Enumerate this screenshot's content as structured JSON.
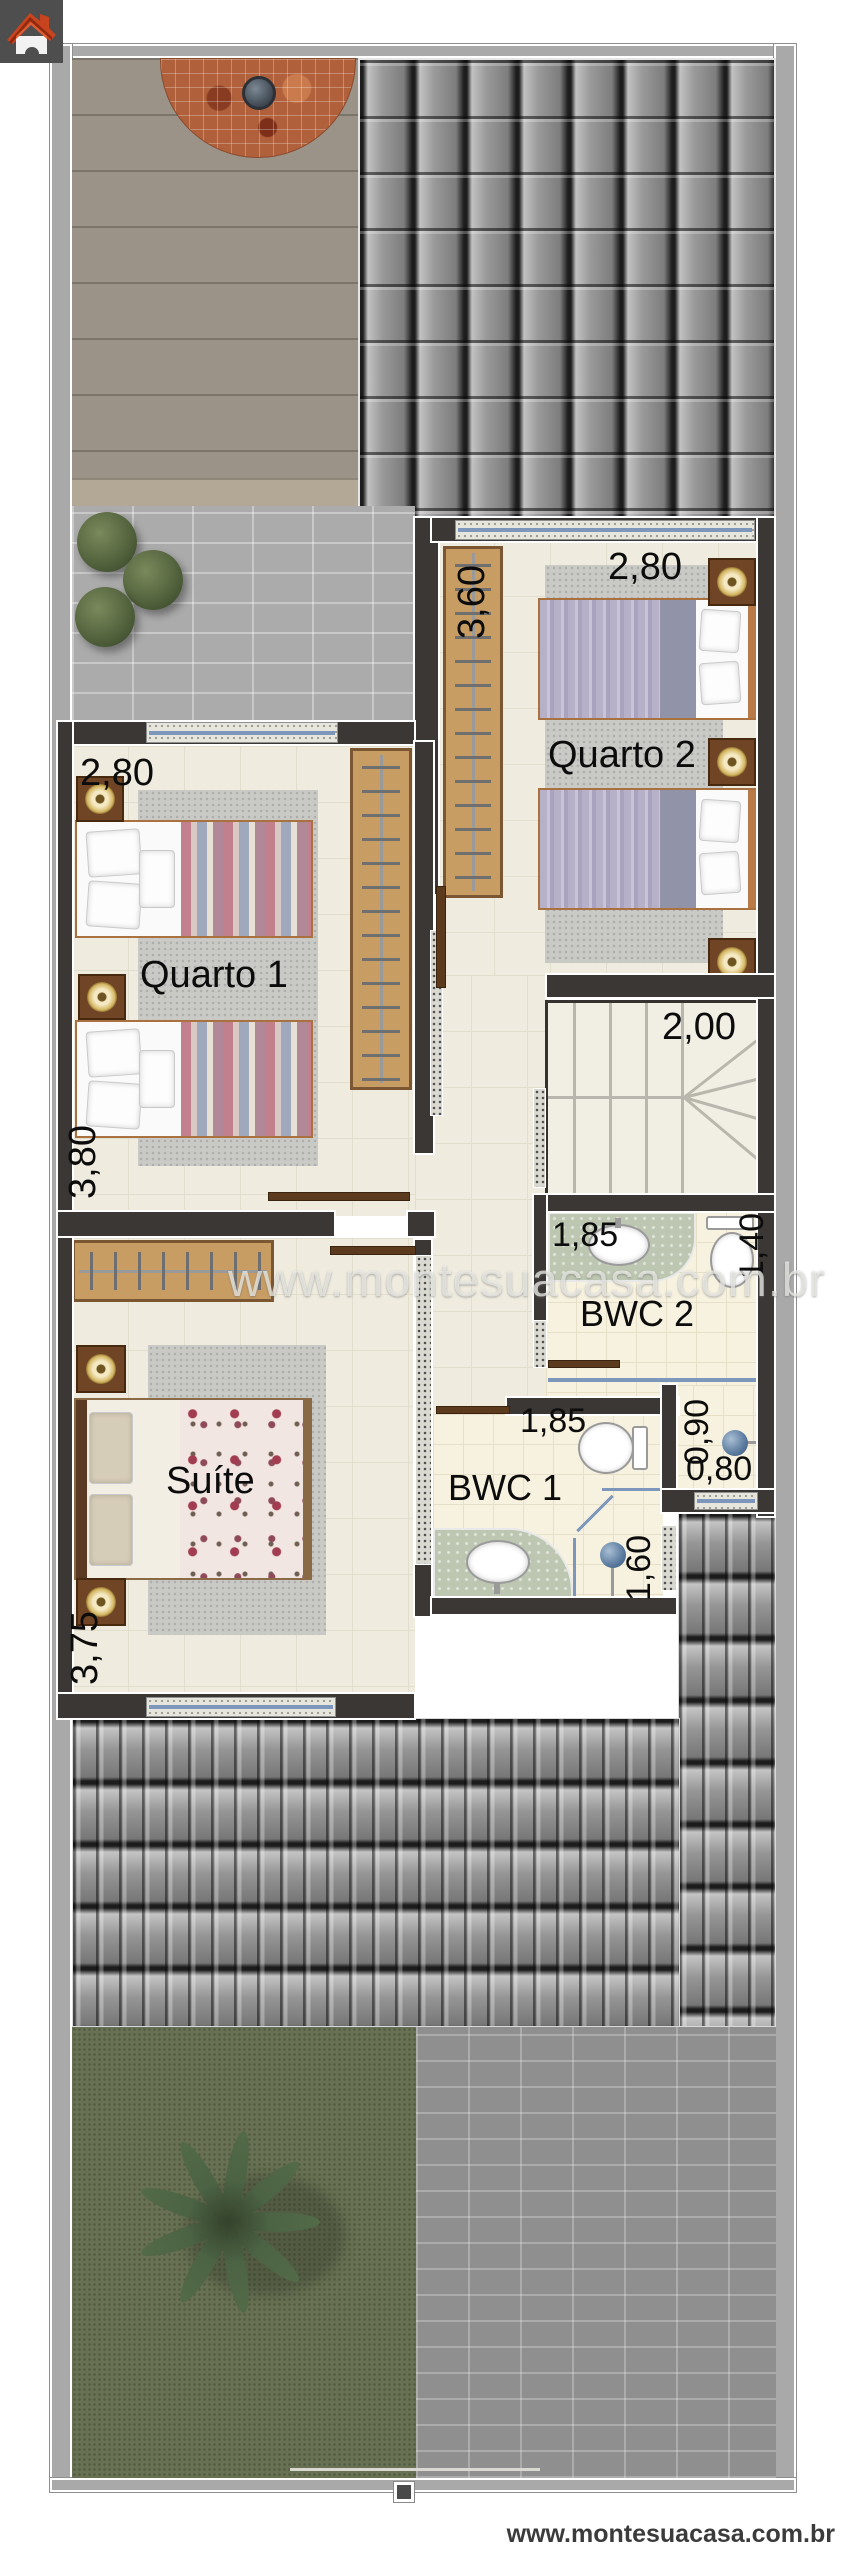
{
  "page": {
    "watermark": "www.montesuacasa.com.br",
    "footer_url": "www.montesuacasa.com.br"
  },
  "icons": {
    "logo": "house-icon"
  },
  "rooms": {
    "quarto2": {
      "label": "Quarto 2",
      "dim_width": "2,80",
      "dim_depth": "3,60"
    },
    "quarto1": {
      "label": "Quarto 1",
      "dim_width": "2,80",
      "dim_depth": "3,80"
    },
    "stairs": {
      "dim_width": "2,00"
    },
    "bwc2": {
      "label": "BWC 2",
      "dim_width": "1,85",
      "dim_depth": "1,40",
      "shower_dim_width": "0,90",
      "shower_dim_depth": "0,80"
    },
    "bwc1": {
      "label": "BWC 1",
      "dim_width": "1,85",
      "shower_dim_depth": "1,60"
    },
    "suite": {
      "label": "Suíte",
      "dim_depth": "3,75"
    }
  },
  "colors": {
    "wall": "#3a3734",
    "floor_tile": "#efecdf",
    "roof_tile": "#9a9a9a",
    "deck": "#9b9387",
    "grass": "#687153",
    "wood": "#c89d63",
    "gold_accent": "#c9a84c",
    "glass_blue": "#7c96bc",
    "marble_counter": "#bcc6b0",
    "mosaic": "#b0603a",
    "logo_red": "#c8441f"
  }
}
